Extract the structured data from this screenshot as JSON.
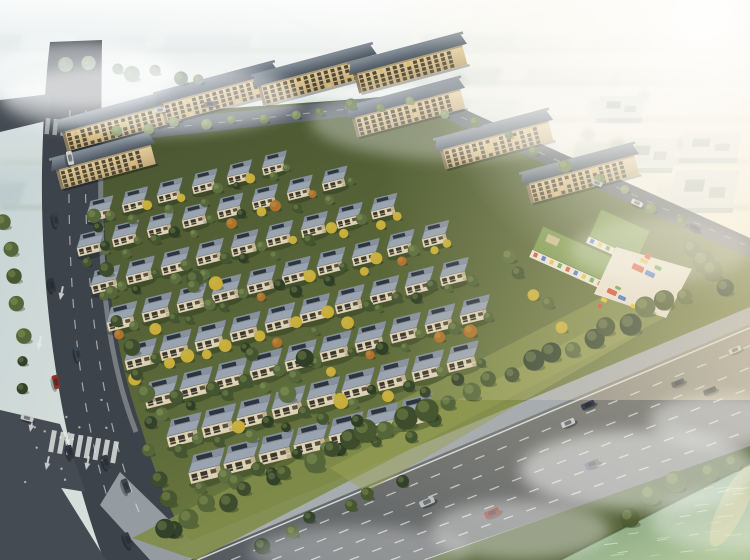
{
  "meta": {
    "title": "Aerial architectural rendering of a residential community with villa rows, apartment slab buildings, kindergarten playground, perimeter roads and riverfront",
    "image_type": "architectural-render",
    "lighting": "hazy warm sunlight from upper right",
    "no_visible_text": true
  },
  "palette": {
    "skyTopLeft": "#c3d1d3",
    "skyMid": "#e0e7df",
    "skyWarm": "#f7f3e1",
    "fog": "#ffffff",
    "warmTint": "#f6e9cc",
    "ground1": "#46522f",
    "ground2": "#5d6a3a",
    "lawn": "#7f8c49",
    "lawnLit": "#9aa257",
    "roadDark": "#3c434a",
    "roadDark2": "#444b52",
    "roadBack": "#5c646b",
    "roadMainL": "#54595e",
    "roadMainR": "#9c998c",
    "sidewalk": "#a7acaf",
    "plaza": "#9aa1a5",
    "marking": "#e6eae7",
    "slabRoof": "#4d5863",
    "slabRoofLit": "#7f8a95",
    "slabFacade1": "#e6cf9e",
    "slabFacade2": "#c2ab7b",
    "slabWin": "#453f2f",
    "slabWinLit": "#d8b96a",
    "slabSide": "#8a7a5e",
    "villaRoofA": "#9aa4b0",
    "villaRoofB": "#87919e",
    "villaPanel": "#2c343e",
    "villaWall": "#ddd1b3",
    "villaWin": "#3b362b",
    "villaSide": "#b3a483",
    "villaRail": "#efe6cf",
    "kgRoof": "#7b984d",
    "kgRoofEdge": "#5c7438",
    "kgWall": "#ece6d9",
    "kgBox": "#c9b98a",
    "court": "#e7e0d1",
    "water0": "#6f8d74",
    "water1": "#8aa884",
    "water2": "#b2c79c",
    "ripple": "#dae7c4",
    "glint": "#e9d89b",
    "bank1": "#57653a",
    "bank2": "#404d2c",
    "boxTop": "#e3e8e2",
    "boxSide": "#bec8bf",
    "boxMark": "#96a198",
    "hazeGreen": "#8ca18a",
    "carGlass": "#20262c",
    "treeShadow": "#15200f",
    "treeHighlight": "#b8c46e"
  },
  "background": {
    "haze_block_colors": [
      "#b4c3c5",
      "#c6d2d1",
      "#a9babc",
      "#ced9d5"
    ],
    "rows": [
      [
        36,
        15,
        9
      ],
      [
        66,
        18,
        9
      ],
      [
        100,
        20,
        8
      ],
      [
        140,
        22,
        8
      ],
      [
        184,
        24,
        7
      ]
    ],
    "haze_tree_count": 14,
    "campus_boxes": [
      [
        600,
        96,
        46,
        22
      ],
      [
        628,
        138,
        50,
        30
      ],
      [
        684,
        132,
        58,
        26
      ],
      [
        676,
        170,
        64,
        38
      ]
    ]
  },
  "apartments": {
    "angle": -15,
    "floors": 4,
    "facade_height": 20,
    "slabs": [
      [
        62,
        132,
        118
      ],
      [
        160,
        104,
        118
      ],
      [
        258,
        86,
        118
      ],
      [
        354,
        74,
        112
      ],
      [
        56,
        170,
        98
      ],
      [
        352,
        118,
        112
      ],
      [
        440,
        150,
        112
      ],
      [
        526,
        184,
        112
      ]
    ]
  },
  "villas": {
    "angle": -14,
    "step": [
      35,
      -9.2
    ],
    "rows": [
      [
        88,
        212,
        6
      ],
      [
        78,
        246,
        8
      ],
      [
        92,
        283,
        9
      ],
      [
        108,
        320,
        10
      ],
      [
        126,
        358,
        10
      ],
      [
        146,
        396,
        10
      ],
      [
        168,
        434,
        9
      ],
      [
        190,
        470,
        7
      ]
    ],
    "yellow_zones": [
      [
        240,
        200,
        190,
        80
      ],
      [
        140,
        320,
        210,
        90
      ]
    ]
  },
  "tree_palettes": {
    "dark": [
      "#3d4c2c",
      "#47572f",
      "#31412a",
      "#55663a"
    ],
    "mid": [
      "#5c7046",
      "#6d8050",
      "#7f9263"
    ],
    "bank": [
      "#4e5c33",
      "#5d6b3a"
    ],
    "haze": [
      "#8a9b88",
      "#7d9084"
    ],
    "villa": [
      "#445531",
      "#54663a",
      "#2f3f26",
      "#5d6f40"
    ],
    "yellow": "#c9ad38",
    "orange": "#b0712c"
  },
  "tree_strips": [
    [
      95,
      205,
      175,
      540,
      13,
      "dark",
      5,
      9,
      14
    ],
    [
      160,
      530,
      700,
      288,
      27,
      "dark",
      7,
      12,
      14
    ],
    [
      100,
      132,
      425,
      100,
      11,
      "mid",
      4,
      6,
      10
    ],
    [
      432,
      104,
      700,
      226,
      9,
      "mid",
      4,
      7,
      10
    ],
    [
      610,
      520,
      748,
      452,
      5,
      "bank",
      7,
      11,
      12
    ],
    [
      5,
      210,
      28,
      400,
      7,
      "dark",
      5,
      8,
      10
    ],
    [
      690,
      240,
      735,
      295,
      4,
      "dark",
      8,
      12,
      12
    ],
    [
      240,
      555,
      420,
      470,
      6,
      "dark",
      6,
      9,
      16
    ],
    [
      505,
      250,
      560,
      330,
      5,
      "villa",
      5,
      8,
      16
    ],
    [
      150,
      250,
      380,
      430,
      8,
      "villa",
      6,
      10,
      70
    ],
    [
      60,
      60,
      210,
      80,
      7,
      "haze",
      5,
      8,
      14
    ]
  ],
  "kindergarten": {
    "wingA": [
      543,
      226,
      24,
      82,
      26
    ],
    "wingB": [
      601,
      209,
      24,
      54,
      30
    ],
    "window_colors": [
      "#d5492f",
      "#3c6cc0",
      "#e2c034",
      "#52a03a"
    ]
  },
  "playground": {
    "court_points": "616,247 692,269 666,318 594,294",
    "colors": {
      "red": "#d5492f",
      "blue": "#3c6cc0",
      "yellow": "#e2c034",
      "green": "#52a03a"
    },
    "pieces": [
      [
        638,
        268,
        12,
        6,
        "red"
      ],
      [
        650,
        274,
        10,
        5,
        "blue"
      ],
      [
        644,
        261,
        8,
        4,
        "yellow"
      ],
      [
        658,
        268,
        7,
        4,
        "green"
      ],
      [
        612,
        292,
        10,
        5,
        "red"
      ],
      [
        622,
        298,
        8,
        4,
        "blue"
      ],
      [
        604,
        300,
        6,
        4,
        "yellow"
      ],
      [
        618,
        288,
        6,
        3,
        "green"
      ],
      [
        648,
        256,
        6,
        6,
        "red"
      ],
      [
        633,
        306,
        5,
        4,
        "yellow"
      ],
      [
        600,
        306,
        4,
        4,
        "red"
      ],
      [
        662,
        300,
        4,
        4,
        "blue"
      ]
    ]
  },
  "cars": [
    [
      70,
      158,
      "#cfd2cf",
      78,
      1
    ],
    [
      56,
      220,
      "#394047",
      78,
      1
    ],
    [
      52,
      285,
      "#2e353c",
      78,
      1
    ],
    [
      78,
      354,
      "#3b4754",
      78,
      1
    ],
    [
      56,
      382,
      "#8e3126",
      78,
      1
    ],
    [
      27,
      418,
      "#c8cbc8",
      15,
      0.9
    ],
    [
      70,
      452,
      "#31383f",
      74,
      1
    ],
    [
      106,
      462,
      "#343b42",
      74,
      1
    ],
    [
      126,
      486,
      "#3e454c",
      70,
      1.05
    ],
    [
      128,
      540,
      "#363c43",
      65,
      1.1
    ],
    [
      160,
      110,
      "#c6cac8",
      -6,
      0.8
    ],
    [
      210,
      104,
      "#565c62",
      -6,
      0.8
    ],
    [
      597,
      183,
      "#b9bdb9",
      25,
      0.8
    ],
    [
      637,
      203,
      "#d6d8d4",
      25,
      0.85
    ],
    [
      695,
      228,
      "#3a4147",
      25,
      0.85
    ],
    [
      427,
      502,
      "#b9bec0",
      -23,
      1.1
    ],
    [
      492,
      513,
      "#8e3228",
      -23,
      1.1
    ],
    [
      568,
      423,
      "#caccca",
      -23,
      1
    ],
    [
      588,
      405,
      "#3a414b",
      -23,
      1
    ],
    [
      592,
      464,
      "#5a6065",
      -23,
      1.05
    ],
    [
      678,
      383,
      "#41484f",
      -23,
      0.95
    ],
    [
      710,
      391,
      "#2f353b",
      -23,
      0.95
    ],
    [
      735,
      350,
      "#c9ccc9",
      -23,
      0.9
    ]
  ],
  "left_road_arrows": [
    [
      38,
      350
    ],
    [
      60,
      300
    ],
    [
      30,
      432
    ],
    [
      66,
      446
    ],
    [
      46,
      470
    ],
    [
      86,
      470
    ]
  ],
  "water": {
    "ripple_count": 26
  },
  "fog_patches": [
    [
      640,
      470,
      120,
      40,
      0.5
    ],
    [
      520,
      530,
      90,
      30,
      0.4
    ],
    [
      720,
      420,
      70,
      26,
      0.45
    ],
    [
      80,
      75,
      95,
      34,
      0.55
    ],
    [
      150,
      98,
      150,
      36,
      0.5
    ],
    [
      730,
      520,
      80,
      30,
      0.35
    ],
    [
      360,
      552,
      110,
      26,
      0.3
    ],
    [
      660,
      250,
      90,
      32,
      0.28
    ],
    [
      460,
      120,
      150,
      40,
      0.35
    ]
  ]
}
